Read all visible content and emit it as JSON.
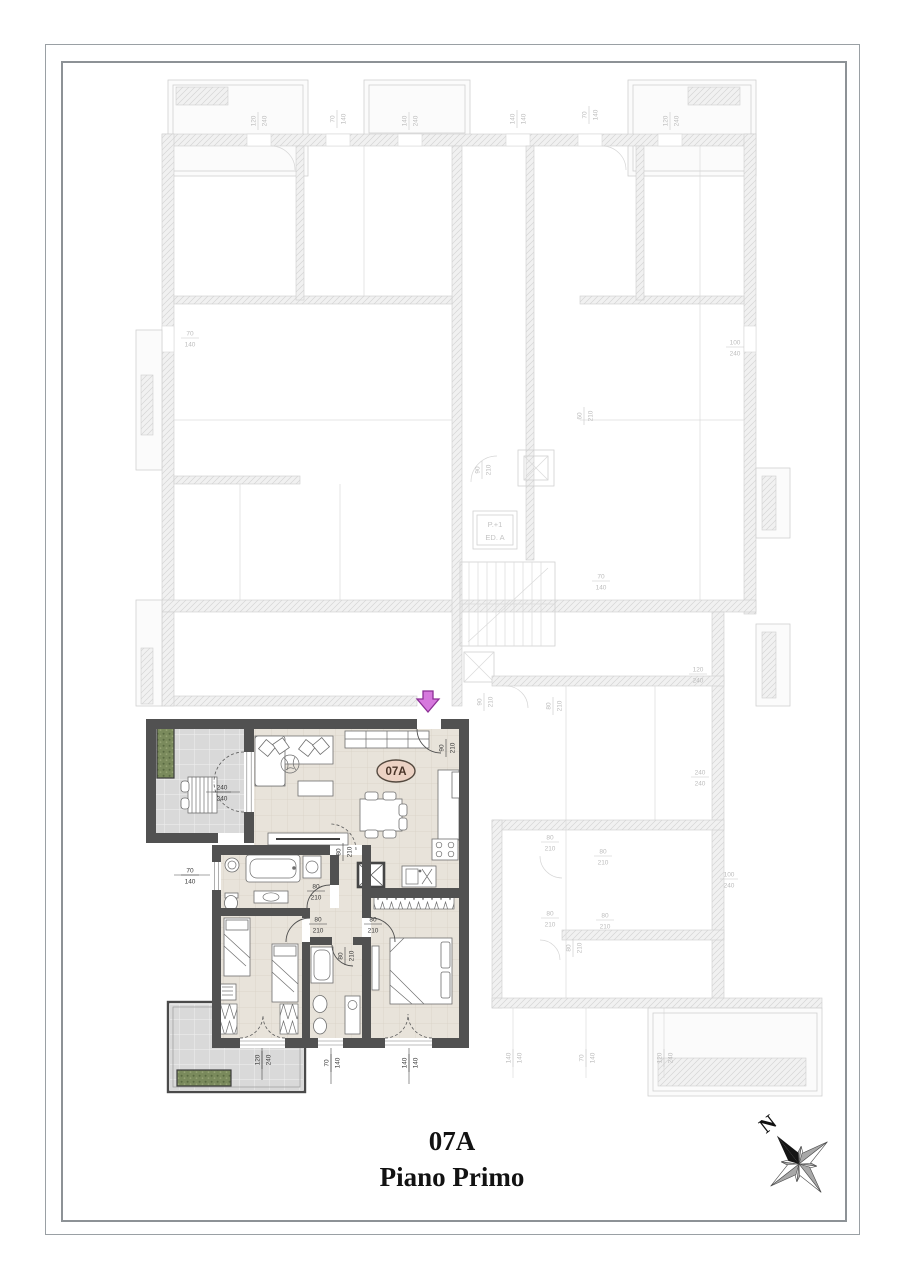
{
  "title_block": {
    "unit": "07A",
    "floor": "Piano Primo"
  },
  "unit_badge": {
    "label": "07A"
  },
  "compass": {
    "label": "N"
  },
  "stairwell": {
    "line1": "P.+1",
    "line2": "ED. A"
  },
  "entrance_arrow": {
    "direction": "down"
  },
  "colors": {
    "wall_dark": "#515151",
    "floor_tile": "#e8e3da",
    "terrace_tile": "#d9d9d9",
    "planter_green": "#7a8a5c",
    "badge_fill": "#ecd2c4",
    "badge_text": "#493428",
    "arrow_fill": "#d678dd",
    "arrow_stroke": "#8d2f96",
    "faded_plan": "#c9c9c9",
    "dim_text": "#3a3a3a",
    "dim_text_faded": "#bcbcbc"
  },
  "dim_labels": {
    "unit": [
      {
        "x": 222,
        "y": 792,
        "rot": 0,
        "top": "240",
        "bottom": "240"
      },
      {
        "x": 190,
        "y": 875,
        "rot": 0,
        "top": "70",
        "bottom": "140"
      },
      {
        "x": 446,
        "y": 748,
        "rot": -90,
        "top": "90",
        "bottom": "210"
      },
      {
        "x": 343,
        "y": 852,
        "rot": -90,
        "top": "80",
        "bottom": "210"
      },
      {
        "x": 316,
        "y": 891,
        "rot": 0,
        "top": "80",
        "bottom": "210"
      },
      {
        "x": 318,
        "y": 924,
        "rot": 0,
        "top": "80",
        "bottom": "210"
      },
      {
        "x": 373,
        "y": 924,
        "rot": 0,
        "top": "80",
        "bottom": "210"
      },
      {
        "x": 345,
        "y": 956,
        "rot": -90,
        "top": "80",
        "bottom": "210"
      },
      {
        "x": 262,
        "y": 1060,
        "rot": -90,
        "top": "120",
        "bottom": "240"
      },
      {
        "x": 331,
        "y": 1063,
        "rot": -90,
        "top": "70",
        "bottom": "140"
      },
      {
        "x": 409,
        "y": 1063,
        "rot": -90,
        "top": "140",
        "bottom": "140"
      }
    ],
    "faded": [
      {
        "x": 258,
        "y": 121,
        "rot": -90,
        "top": "120",
        "bottom": "240"
      },
      {
        "x": 337,
        "y": 119,
        "rot": -90,
        "top": "70",
        "bottom": "140"
      },
      {
        "x": 409,
        "y": 121,
        "rot": -90,
        "top": "140",
        "bottom": "240"
      },
      {
        "x": 517,
        "y": 119,
        "rot": -90,
        "top": "140",
        "bottom": "140"
      },
      {
        "x": 589,
        "y": 115,
        "rot": -90,
        "top": "70",
        "bottom": "140"
      },
      {
        "x": 670,
        "y": 121,
        "rot": -90,
        "top": "120",
        "bottom": "240"
      },
      {
        "x": 190,
        "y": 338,
        "rot": 0,
        "top": "70",
        "bottom": "140"
      },
      {
        "x": 735,
        "y": 347,
        "rot": 0,
        "top": "100",
        "bottom": "240"
      },
      {
        "x": 584,
        "y": 416,
        "rot": -90,
        "top": "60",
        "bottom": "210"
      },
      {
        "x": 601,
        "y": 581,
        "rot": 0,
        "top": "70",
        "bottom": "140"
      },
      {
        "x": 482,
        "y": 470,
        "rot": -90,
        "top": "90",
        "bottom": "210"
      },
      {
        "x": 484,
        "y": 702,
        "rot": -90,
        "top": "90",
        "bottom": "210"
      },
      {
        "x": 553,
        "y": 706,
        "rot": -90,
        "top": "80",
        "bottom": "210"
      },
      {
        "x": 698,
        "y": 674,
        "rot": 0,
        "top": "120",
        "bottom": "240"
      },
      {
        "x": 700,
        "y": 777,
        "rot": 0,
        "top": "240",
        "bottom": "240"
      },
      {
        "x": 729,
        "y": 879,
        "rot": 0,
        "top": "100",
        "bottom": "240"
      },
      {
        "x": 550,
        "y": 842,
        "rot": 0,
        "top": "80",
        "bottom": "210"
      },
      {
        "x": 603,
        "y": 856,
        "rot": 0,
        "top": "80",
        "bottom": "210"
      },
      {
        "x": 550,
        "y": 918,
        "rot": 0,
        "top": "80",
        "bottom": "210"
      },
      {
        "x": 605,
        "y": 920,
        "rot": 0,
        "top": "80",
        "bottom": "210"
      },
      {
        "x": 573,
        "y": 948,
        "rot": -90,
        "top": "80",
        "bottom": "210"
      },
      {
        "x": 513,
        "y": 1058,
        "rot": -90,
        "top": "140",
        "bottom": "140"
      },
      {
        "x": 586,
        "y": 1058,
        "rot": -90,
        "top": "70",
        "bottom": "140"
      },
      {
        "x": 664,
        "y": 1058,
        "rot": -90,
        "top": "120",
        "bottom": "240"
      }
    ]
  }
}
